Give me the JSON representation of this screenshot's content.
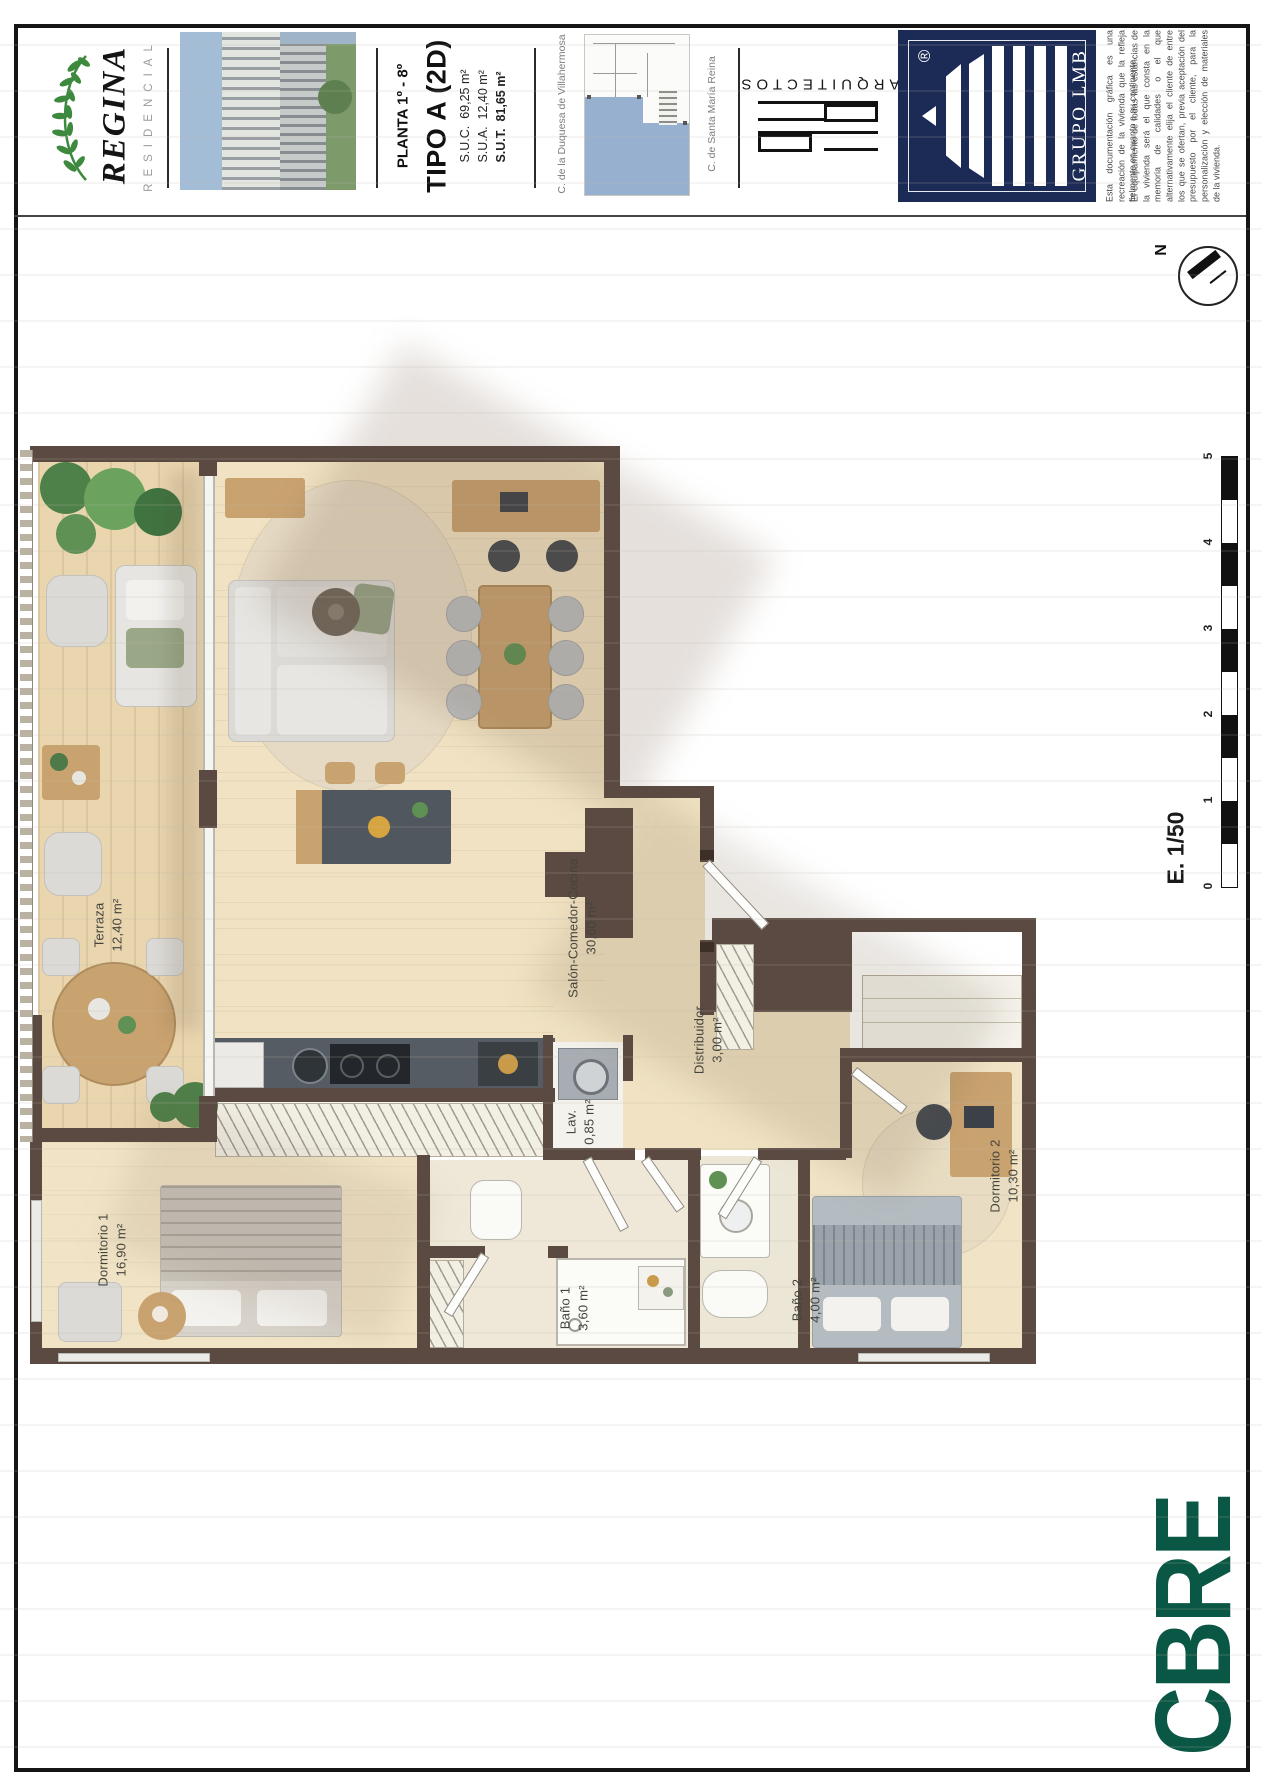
{
  "header": {
    "brand": {
      "name": "REGINA",
      "subtitle": "RESIDENCIAL"
    },
    "plate": {
      "floor": "PLANTA 1º - 8º",
      "type": "TIPO A (2D)",
      "areas": [
        {
          "label": "S.U.C.",
          "value": "69,25 m²"
        },
        {
          "label": "S.U.A.",
          "value": "12,40 m²"
        },
        {
          "label": "S.U.T.",
          "value": "81,65 m²"
        }
      ]
    },
    "location": {
      "street_left": "C. de la Duquesa de Villahermosa",
      "street_right": "C. de Santa María Reina"
    },
    "architects_label": "ARQUITECTOS",
    "grupo": {
      "name": "GRUPO LMB",
      "registered": "®"
    },
    "disclaimer": {
      "p1": "Esta documentación gráfica es una recreación de la vivienda que la refleja fielmente en cuanto a su continente.",
      "p2": "El equipamiento de todas las estancias de la vivienda será el que consta en la memoria de calidades o el que alternativamente elija el cliente de entre los que se ofertan, previa aceptación del presupuesto por el cliente, para la personalización y elección de materiales de la vivienda."
    }
  },
  "plan": {
    "rooms": [
      {
        "name": "Terraza",
        "area": "12,40 m²"
      },
      {
        "name": "Salón-Comedor-Cocina",
        "area": "30,60 m²"
      },
      {
        "name": "Distribuidor",
        "area": "3,00 m²"
      },
      {
        "name": "Lav.",
        "area": "0,85 m²"
      },
      {
        "name": "Dormitorio 1",
        "area": "16,90 m²"
      },
      {
        "name": "Baño 1",
        "area": "3,60 m²"
      },
      {
        "name": "Baño 2",
        "area": "4,00 m²"
      },
      {
        "name": "Dormitorio 2",
        "area": "10,30 m²"
      }
    ],
    "compass_label": "N",
    "scale": {
      "label": "E. 1/50",
      "ticks": [
        "5",
        "4",
        "3",
        "2",
        "1",
        "0"
      ]
    }
  },
  "footer": {
    "brand": "CBRE"
  },
  "colors": {
    "wall_brown": "#5a4a41",
    "floor_beige": "#f0e2c2",
    "terrace_wood": "#e9d5ae",
    "keyplan_blue": "#8fa9cc",
    "grupo_navy": "#1c2b56",
    "cbre_green": "#0a5745",
    "laurel_green": "#3d8a3f"
  }
}
